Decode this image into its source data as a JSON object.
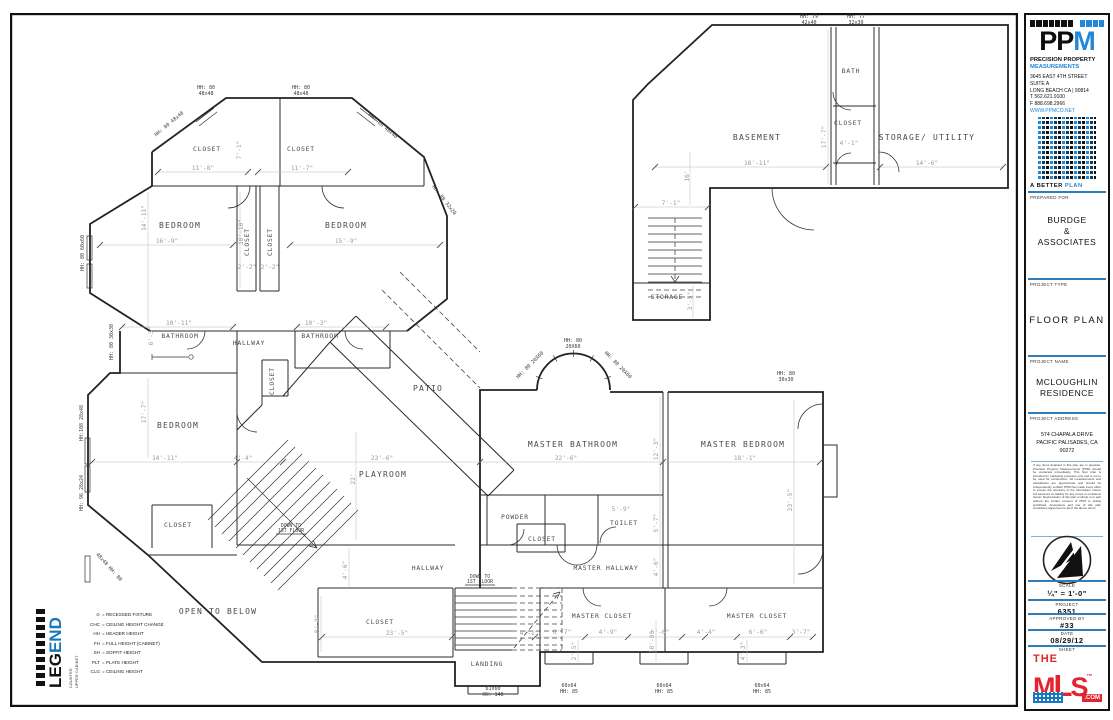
{
  "colors": {
    "accent_blue": "#2e7cb8",
    "logo_blue": "#2288d8",
    "mls_red": "#e32430"
  },
  "titleblock": {
    "company": {
      "initials_black": "PP",
      "initials_blue": "M",
      "name_line1": "PRECISION PROPERTY",
      "name_line2": "MEASUREMENTS",
      "address": [
        "3645 EAST 4TH STREET",
        "SUITE A",
        "LONG BEACH  CA | 90814",
        "T   562.621.9100",
        "F   888.698.2966",
        "WWW.PPMCO.NET"
      ],
      "tagline_a": "A BETTER ",
      "tagline_b": "PLAN"
    },
    "prepared_for": {
      "label": "PREPARED FOR",
      "lines": [
        "BURDGE",
        "&",
        "ASSOCIATES"
      ]
    },
    "project_type": {
      "label": "PROJECT TYPE",
      "value": "FLOOR PLAN"
    },
    "project_name": {
      "label": "PROJECT NAME",
      "lines": [
        "MCLOUGHLIN",
        "RESIDENCE"
      ]
    },
    "project_address": {
      "label": "PROJECT ADDRESS",
      "lines": [
        "574 CHAPALA DRIVE",
        "PACIFIC PALISADES, CA",
        "90272"
      ]
    },
    "disclaimer": "If any items depicted in this plan are in question, Precision Property Measurements (PPM) should be contacted immediately. This floor plan is intended for marketing purposes only and is not to be used for construction. All measurements and calculations are approximate and should be independently verified. PPM has made every effort to ensure the accuracy of the information shown but assumes no liability for any errors or omissions herein. Reproduction of this plan in whole or in part without the written consent of PPM is strictly prohibited. Acceptance and use of this plan constitutes agreement to all of the above terms.",
    "scale": {
      "label": "SCALE",
      "value": "¼\" = 1'-0\""
    },
    "project_no": {
      "label": "PROJECT",
      "value": "6351"
    },
    "approved": {
      "label": "APPROVED BY",
      "value": "#33"
    },
    "date": {
      "label": "DATE",
      "value": "08/29/12"
    },
    "sheet": {
      "label": "SHEET"
    },
    "mls": {
      "the": "THE",
      "m": "M",
      "l": "L",
      "s": "S",
      "tm": "™",
      "com": ".COM"
    }
  },
  "legend": {
    "title_black": "LEG",
    "title_blue": "END",
    "counter": "COUNTER",
    "upper": "UPPER CABINET",
    "items": [
      [
        "⊙",
        "= RECESSED FIXTURE"
      ],
      [
        "CHC",
        "= CEILING HEIGHT CHANGE"
      ],
      [
        "HH",
        "= HEADER HEIGHT"
      ],
      [
        "FH",
        "= FULL HEIGHT (CABINET)"
      ],
      [
        "SH",
        "= SOFFIT HEIGHT"
      ],
      [
        "PLT",
        "= PLATE HEIGHT"
      ],
      [
        "CLG",
        "= CEILING HEIGHT"
      ]
    ]
  },
  "plan": {
    "rooms": [
      "CLOSET",
      "CLOSET",
      "BEDROOM",
      "BEDROOM",
      "CLOSET",
      "CLOSET",
      "BATHROOM",
      "HALLWAY",
      "BATHROOM",
      "CLOSET",
      "BEDROOM",
      "PATIO",
      "PLAYROOM",
      "MASTER BATHROOM",
      "MASTER BEDROOM",
      "POWDER",
      "CLOSET",
      "TOILET",
      "MASTER HALLWAY",
      "MASTER CLOSET",
      "MASTER CLOSET",
      "HALLWAY",
      "CLOSET",
      "LANDING",
      "OPEN TO BELOW",
      "CLOSET",
      "BASEMENT",
      "BATH",
      "CLOSET",
      "STORAGE/ UTILITY",
      "STORAGE"
    ],
    "dims": [
      "11'-8\"",
      "11'-7\"",
      "7'-1\"",
      "16'-9\"",
      "15'-9\"",
      "14'-11\"",
      "10'-10\"",
      "2'-2\"",
      "2'-2\"",
      "10'-11\"",
      "10'-3\"",
      "6'-3\"",
      "17'-7\"",
      "14'-11\"",
      "4'-4\"",
      "23'-6\"",
      "22'-6\"",
      "18'-1\"",
      "22'",
      "12'-3\"",
      "23'-5\"",
      "5'-9\"",
      "5'-7\"",
      "4'-6\"",
      "8'-4\"",
      "4'-6\"",
      "23'-5\"",
      "4'-1\"",
      "6'-7\"",
      "4'-9\"",
      "6'-6\"",
      "4'-4\"",
      "6'-6\"",
      "3'-7\"",
      "10'-9\"",
      "2'-5\"",
      "4'-3\"",
      "18'-11\"",
      "14'-6\"",
      "17'-7\"",
      "7'-1\"",
      "16'",
      "3'-5\"",
      "4'-1\""
    ],
    "windows": [
      "HH: 80",
      "48x48",
      "HH: 80",
      "48x48",
      "HH: 80 48x48",
      "HH: 80 48x48",
      "HH: 80 60x60",
      "HH: 80 30x30",
      "HH:108 28x48",
      "HH: 96 28x24",
      "48x48 HH: 80",
      "HH: 80 32x20",
      "HH: 80",
      "20X60",
      "HH: 80 20X60",
      "HH: 80 20X60",
      "HH: 80",
      "30x30",
      "HH: 79",
      "42x40",
      "HH: 77",
      "32x30",
      "60x64",
      "HH: 85",
      "60x64",
      "HH: 85",
      "60x64",
      "HH: 85",
      "61x60",
      "HH: 148",
      "DOWN TO",
      "1ST FLOOR",
      "DOWN TO",
      "1ST FLOOR"
    ]
  }
}
